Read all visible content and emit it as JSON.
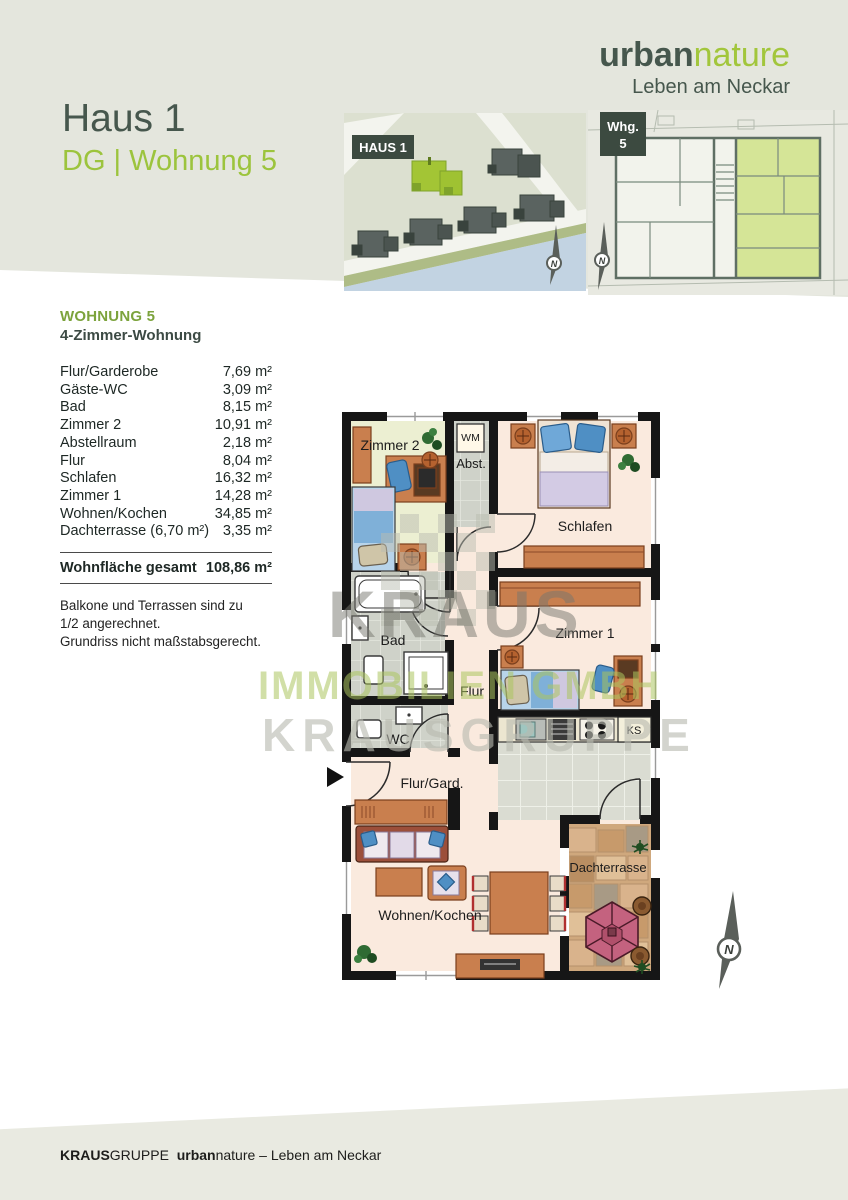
{
  "header": {
    "logo": {
      "brand_bold": "urban",
      "brand_light": "nature",
      "tagline": "Leben am Neckar"
    },
    "title": "Haus 1",
    "subtitle": "DG | Wohnung 5",
    "site_label": "HAUS 1",
    "unit_label_line1": "Whg.",
    "unit_label_line2": "5"
  },
  "info": {
    "heading": "WOHNUNG 5",
    "subheading": "4-Zimmer-Wohnung",
    "rows": [
      {
        "name": "Flur/Garderobe",
        "area": "7,69 m²"
      },
      {
        "name": "Gäste-WC",
        "area": "3,09 m²"
      },
      {
        "name": "Bad",
        "area": "8,15 m²"
      },
      {
        "name": "Zimmer 2",
        "area": "10,91 m²"
      },
      {
        "name": "Abstellraum",
        "area": "2,18 m²"
      },
      {
        "name": "Flur",
        "area": "8,04 m²"
      },
      {
        "name": "Schlafen",
        "area": "16,32 m²"
      },
      {
        "name": "Zimmer 1",
        "area": "14,28 m²"
      },
      {
        "name": "Wohnen/Kochen",
        "area": "34,85 m²"
      },
      {
        "name": "Dachterrasse (6,70 m²)",
        "area": "3,35 m²"
      }
    ],
    "total_label": "Wohnfläche gesamt",
    "total_value": "108,86 m²",
    "notes": [
      "Balkone und Terrassen sind zu",
      "1/2 angerechnet.",
      "Grundriss nicht maßstabsgerecht."
    ]
  },
  "plan": {
    "rooms": {
      "zimmer2": "Zimmer 2",
      "abst": "Abst.",
      "wm": "WM",
      "schlafen": "Schlafen",
      "bad": "Bad",
      "flur": "Flur",
      "wc": "WC",
      "zimmer1": "Zimmer 1",
      "ks": "KS",
      "flurgard": "Flur/Gard.",
      "wohnen": "Wohnen/Kochen",
      "dachterrasse": "Dachterrasse"
    },
    "north": "N"
  },
  "watermark": {
    "line1": "KRAUS",
    "line2": "IMMOBILIEN GMBH",
    "line3": "KRAUSGRUPPE"
  },
  "footer": {
    "brand_bold": "KRAUS",
    "brand_rest": "GRUPPE",
    "product_bold": "urban",
    "product_rest": "nature – Leben am Neckar"
  },
  "colors": {
    "header_band": "#e4e6dd",
    "footer_band": "#e9eae1",
    "dark_green": "#46574d",
    "light_green": "#9cc43d",
    "floor_cream": "#faeade",
    "floor_room2": "#ecefd2",
    "tile_gray": "#d2d5cc",
    "terrace_tan": "#cfa87d",
    "furniture_orange": "#c97f4e",
    "parasol_pink": "#c4627f",
    "wall_black": "#161616"
  }
}
